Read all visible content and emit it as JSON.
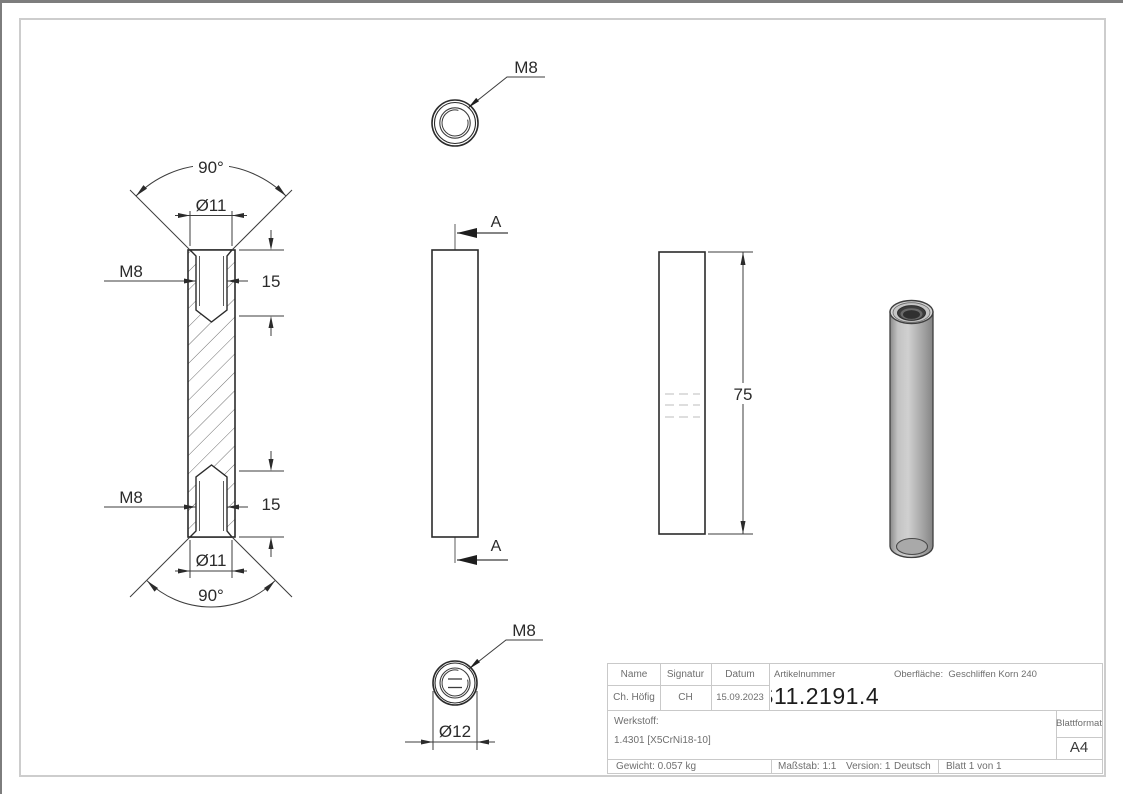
{
  "drawing": {
    "section_view": {
      "angle_top": "90°",
      "dia_top": "Ø11",
      "thread_top": "M8",
      "depth_top": "15",
      "thread_bottom": "M8",
      "depth_bottom": "15",
      "dia_bottom": "Ø11",
      "angle_bottom": "90°"
    },
    "front_view": {
      "section_top": "A",
      "section_bottom": "A"
    },
    "side_view": {
      "length": "75"
    },
    "top_view": {
      "thread": "M8"
    },
    "bottom_view": {
      "thread": "M8",
      "diameter": "Ø12"
    }
  },
  "title_block": {
    "labels": {
      "name": "Name",
      "signatur": "Signatur",
      "datum": "Datum",
      "artikelnummer": "Artikelnummer",
      "oberflaeche": "Oberfläche:",
      "werkstoff": "Werkstoff:",
      "blattformat": "Blattformat"
    },
    "values": {
      "name": "Ch. Höfig",
      "signatur": "CH",
      "datum": "15.09.2023",
      "artikelnummer": "11.2191.4",
      "artikelnummer_clipped_prefix": "S",
      "oberflaeche": "Geschliffen Korn 240",
      "werkstoff": "1.4301 [X5CrNi18-10]",
      "blattformat": "A4",
      "gewicht": "Gewicht: 0.057 kg",
      "massstab": "Maßstab: 1:1",
      "version": "Version: 1",
      "sprache": "Deutsch",
      "blatt": "Blatt 1 von 1"
    }
  },
  "colors": {
    "edge_line": "#2b2b2b",
    "dimension_line": "#3c3c3c",
    "sheet_frame": "#cdcdcd",
    "outer_border": "#7d7d7d",
    "title_text": "#6e6e6e",
    "hidden_line": "#bcbcbc",
    "metal_light": "#d0d0d0",
    "metal_dark": "#888888"
  }
}
